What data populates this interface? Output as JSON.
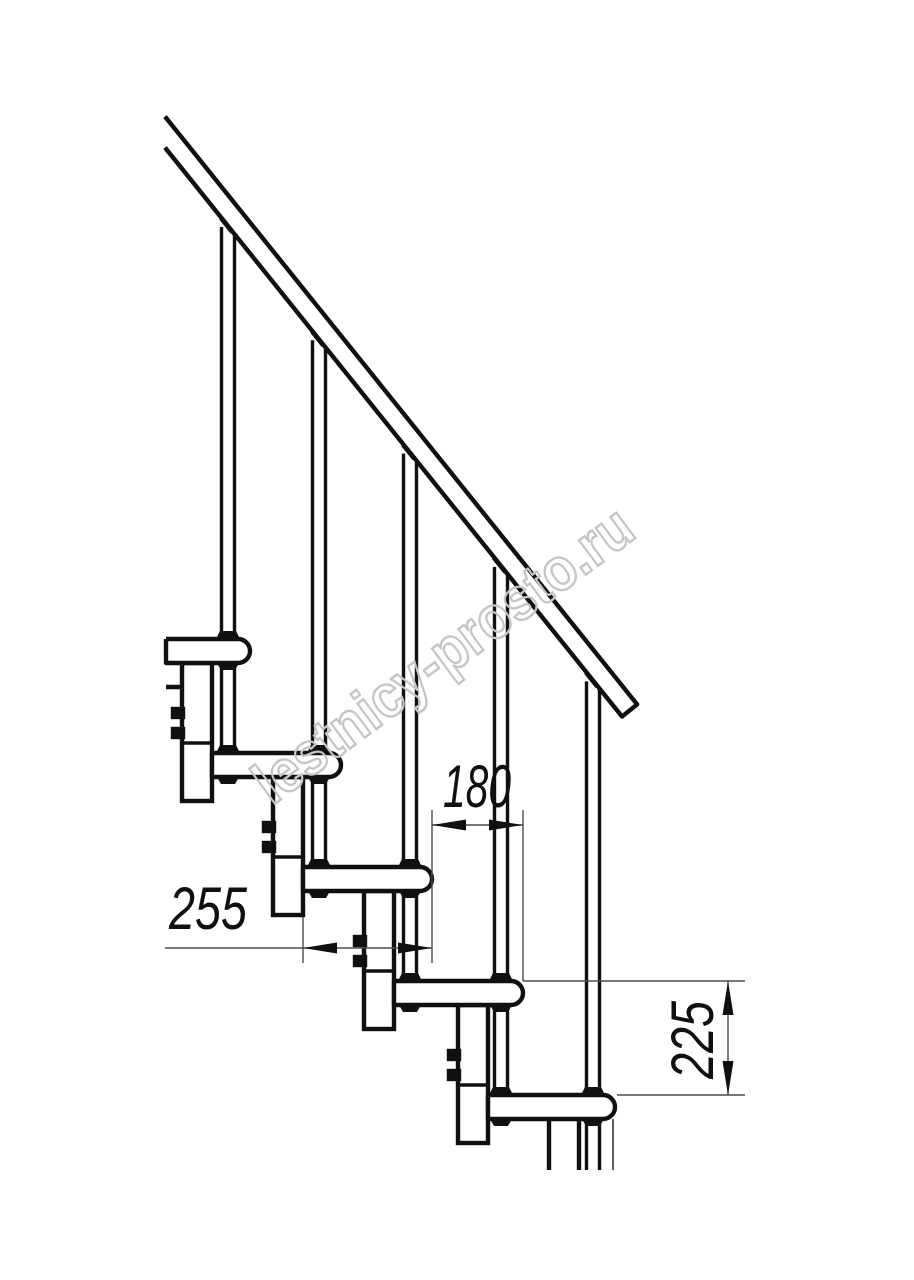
{
  "page": {
    "width": 914,
    "height": 1280,
    "background": "#ffffff"
  },
  "drawing": {
    "title": "modular staircase side elevation",
    "style": {
      "line_color": "#101010",
      "rod_line_color": "#101010",
      "thin_line_color": "#4d4d4d",
      "text_color": "#101010",
      "main_stroke": 4.4,
      "rod_stroke": 3.4,
      "thin_stroke": 1.4,
      "dim_font_size": 60
    },
    "watermark": {
      "text": "lestnicy-prosto.ru",
      "stroke": "#c5c5c5",
      "stroke_width": 2.4,
      "x": 272,
      "y": 806,
      "rotation": -36.4,
      "font_size": 60,
      "text_length": 455
    },
    "geometry": {
      "rail": {
        "x_start": 165,
        "ref_x": 228,
        "ref_underside_y": 226,
        "slope": 1.245,
        "vertical_thickness": 31,
        "end_underside_x": 622
      },
      "step_thickness": 24,
      "nose_radius": 12,
      "module_width": 30,
      "cut_bottom_y": 1170,
      "steps": [
        {
          "left": 166,
          "nose": 250,
          "top": 639,
          "cut_left": true
        },
        {
          "left": 212,
          "nose": 341,
          "top": 753
        },
        {
          "left": 303,
          "nose": 432,
          "top": 867
        },
        {
          "left": 394,
          "nose": 523,
          "top": 981
        },
        {
          "left": 488,
          "nose": 615,
          "top": 1095
        }
      ],
      "rod_centers": [
        228,
        319,
        410,
        501,
        593
      ],
      "rod_half_gap": 6.5,
      "modules": [
        {
          "x": 182,
          "top": 663,
          "bottom": 801,
          "joint": 743,
          "bolts": [
            709,
            729
          ]
        },
        {
          "x": 273,
          "top": 777,
          "bottom": 915,
          "joint": 857,
          "bolts": [
            823,
            843
          ]
        },
        {
          "x": 364,
          "top": 891,
          "bottom": 1029,
          "joint": 971,
          "bolts": [
            937,
            957
          ]
        },
        {
          "x": 458,
          "top": 1005,
          "bottom": 1143,
          "joint": 1085,
          "bolts": [
            1051,
            1071
          ]
        },
        {
          "x": 549,
          "top": 1119,
          "bottom": 1170,
          "partial": true
        }
      ],
      "extra_lines": {
        "floor_stub": [
          166,
          687,
          184,
          687
        ],
        "nose_drop_line": [
          613,
          1119,
          613,
          1170
        ]
      }
    },
    "dimensions": [
      {
        "id": "tread-depth",
        "value": "255",
        "orientation": "horizontal",
        "line_y": 948,
        "line_from_x": 165,
        "line_to_x": 432,
        "arrow_a_x": 303,
        "arrow_b_x": 432,
        "ext_lines": [
          [
            303,
            917,
            303,
            963
          ]
        ],
        "text_x": 208,
        "text_y": 929,
        "text_length": 78
      },
      {
        "id": "step-run",
        "value": "180",
        "orientation": "horizontal",
        "line_y": 825,
        "line_from_x": 432,
        "line_to_x": 523,
        "arrow_a_x": 432,
        "arrow_b_x": 523,
        "ext_lines": [
          [
            432,
            810,
            432,
            963
          ],
          [
            523,
            810,
            523,
            981
          ]
        ],
        "text_x": 477,
        "text_y": 807,
        "text_length": 68
      },
      {
        "id": "step-rise",
        "value": "225",
        "orientation": "vertical",
        "line_x": 728,
        "line_from_y": 981,
        "line_to_y": 1095,
        "ext_lines": [
          [
            523,
            981,
            745,
            981
          ],
          [
            617,
            1095,
            745,
            1095
          ]
        ],
        "text_x": 713,
        "text_y": 1040,
        "text_length": 78
      }
    ]
  }
}
